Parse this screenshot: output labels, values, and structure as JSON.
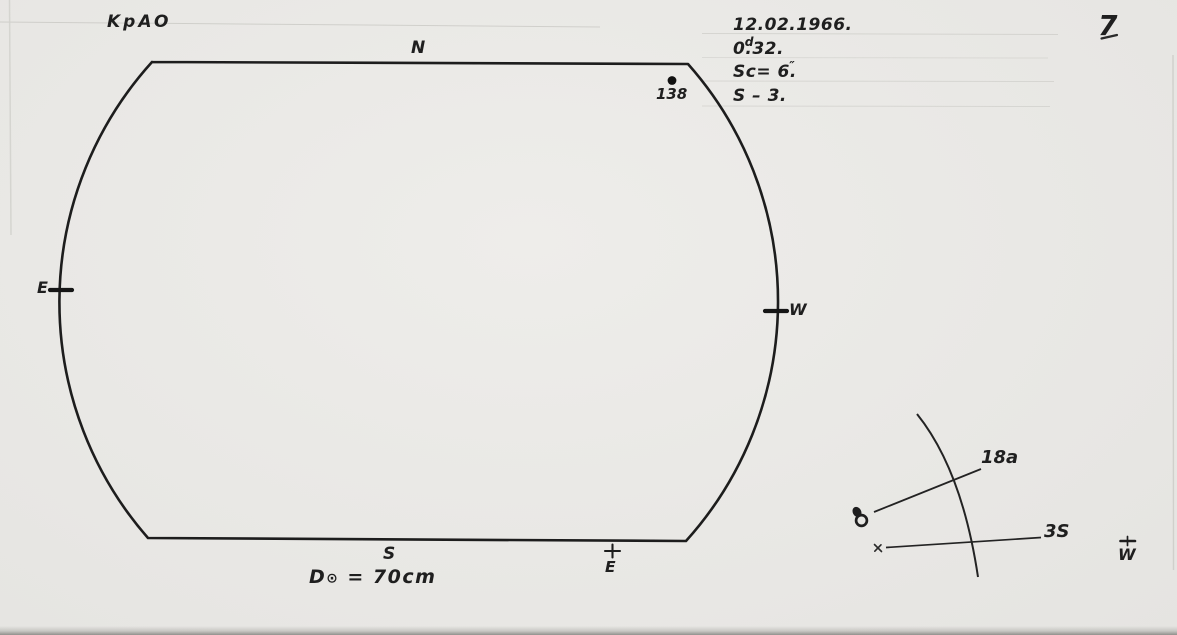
{
  "page": {
    "observatory_label": "KpAO",
    "page_number": "7"
  },
  "observation_info": {
    "date": "12.02.1966.",
    "time_base": "0",
    "time_marker": "d",
    "time_dot": ".",
    "time_rest": "32.",
    "seeing_base": "Sc= 6",
    "seeing_dot": ".",
    "seeing_marker": "″",
    "series": "S – 3."
  },
  "solar_disk": {
    "north_label": "N",
    "south_label": "S",
    "east_label": "E",
    "west_label": "W",
    "sunspot_group_number": "138",
    "diameter_prefix": "D",
    "diameter_symbol": "⊙",
    "diameter_rest": " = 70cm",
    "bottom_east_label": "E"
  },
  "detail_sketch": {
    "group_label": "18a",
    "spot_label": "3S",
    "west_label": "W"
  },
  "colors": {
    "paper": "#e9e8e5",
    "ink": "#1f1f1f",
    "faint_rule": "#b8b8b2"
  }
}
